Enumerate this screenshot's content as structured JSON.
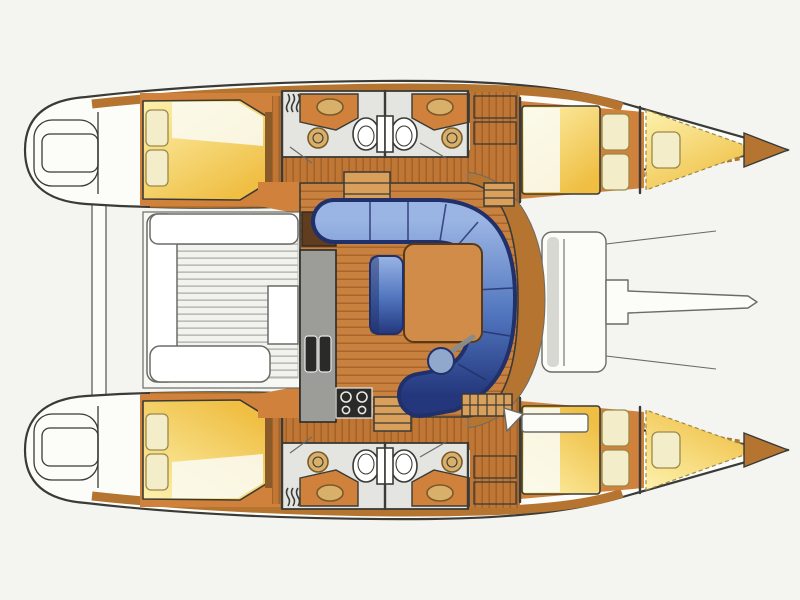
{
  "diagram": {
    "type": "floorplan",
    "subject": "sailing-catamaran-interior-layout-top-view",
    "orientation": "bows-pointing-right",
    "counts": {
      "hulls": 2,
      "double_cabins": 4,
      "bathrooms": 4,
      "forepeak_berths": 2
    },
    "areas": {
      "port_hull": {
        "aft_cabin": [
          "double-berth",
          "two-pillows",
          "white-sheet"
        ],
        "bathrooms": [
          "washbasin-vanity",
          "round-shower-tray",
          "toilet",
          "shower-mixer-symbol"
        ],
        "wardrobe": [
          "locker-boxes"
        ],
        "forward_cabin": [
          "double-berth",
          "two-pillows"
        ],
        "forepeak": [
          "single-berth-cushion"
        ],
        "stern": [
          "transom-steps",
          "swim-platform"
        ]
      },
      "starboard_hull": {
        "note": "mirror-of-port-hull",
        "aft_cabin": [
          "double-berth",
          "two-pillows",
          "white-sheet"
        ],
        "bathrooms": [
          "washbasin-vanity",
          "round-shower-tray",
          "toilet",
          "shower-mixer-symbol"
        ],
        "forward_cabin": [
          "double-berth",
          "two-pillows"
        ],
        "forepeak": [
          "single-berth-cushion"
        ],
        "stern": [
          "transom-steps",
          "swim-platform"
        ]
      },
      "bridgedeck": {
        "cockpit": [
          "l-bench-seating",
          "slatted-teak-floor",
          "cockpit-table"
        ],
        "salon": [
          "curved-blue-sofa",
          "wood-dining-table",
          "blue-armchair",
          "round-stool"
        ],
        "galley": [
          "tall-cabinet",
          "worktop-counter",
          "double-sink",
          "four-burner-stove"
        ],
        "stairs": [
          "steps-to-port-hull",
          "steps-to-starboard-hull"
        ],
        "storage": [
          "louvered-locker-forward-port",
          "louvered-locker-forward-starboard",
          "deck-hatch"
        ]
      },
      "foredeck": [
        "forward-crossbeam",
        "bowsprit",
        "trampoline-area"
      ],
      "aft": [
        "aft-crossbeam"
      ]
    }
  },
  "colors": {
    "paper": "#f4f4f0",
    "outline": "#3a3a36",
    "line_soft": "#6b6b66",
    "hull_white": "#fcfcf9",
    "deck_wood": "#b5742f",
    "floor_wood": "#c9813f",
    "floor_wood_line": "#a5622a",
    "corridor_wood": "#c07736",
    "corridor_line": "#9e5f26",
    "cabin_orange": "#d0813c",
    "bed_light": "#fdf2ae",
    "bed_deep": "#efbe42",
    "pillow": "#f3edc9",
    "pillow_line": "#9a8a4a",
    "sheet": "#fbfaf1",
    "bath_floor": "#e4e4e0",
    "fixture": "#ffffff",
    "sink_tan": "#d9b06a",
    "sink_ring": "#7a5a28",
    "sofa_light": "#9ab4e4",
    "sofa_mid": "#4f74bd",
    "sofa_navy": "#20306a",
    "table_wood": "#d18c49",
    "table_edge": "#5a3a16",
    "stool_blue": "#8fa8cc",
    "counter_gray": "#9c9c98",
    "appliance": "#2a2a28",
    "burner": "#e8e8e4",
    "slat": "#f2f2ee",
    "slat_line": "#b7b7b2",
    "beam_gray": "#d8d8d2",
    "bench_white": "#ffffff",
    "step_wood": "#d9a05c",
    "dark_wood": "#5f3d1e"
  }
}
